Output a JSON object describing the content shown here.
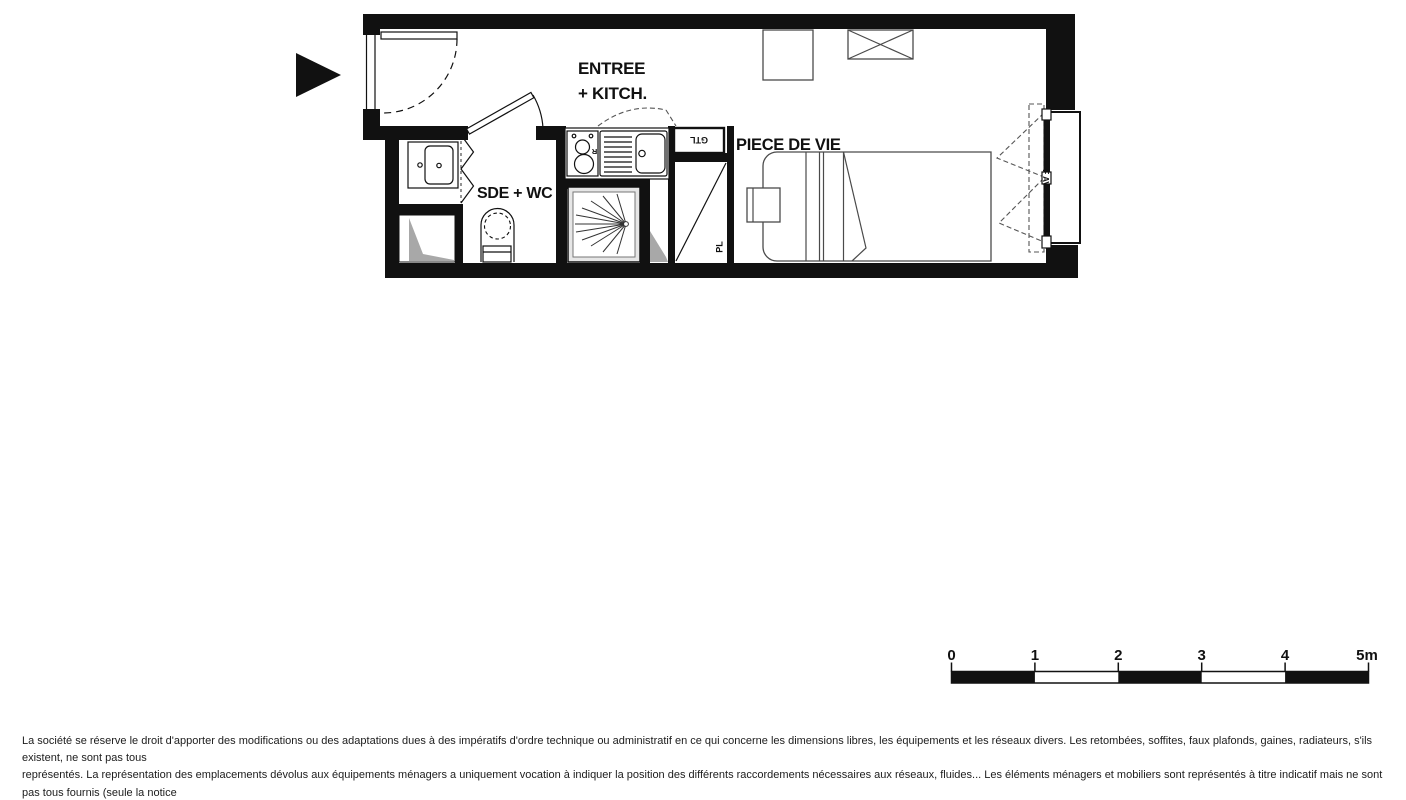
{
  "plan": {
    "labels": {
      "entree_line1": "ENTREE",
      "entree_line2": "+ KITCH.",
      "sde_wc": "SDE + WC",
      "piece_de_vie": "PIECE DE VIE",
      "gtl": "GTL",
      "pl": "PL",
      "fridge": "R",
      "window": "F AV"
    },
    "colors": {
      "wall": "#111111",
      "furniture_line": "#4a4a4a",
      "shade_gray": "#a8a8a8",
      "shower_fill": "#e6e6e6",
      "background": "#ffffff"
    }
  },
  "scale_bar": {
    "labels": [
      "0",
      "1",
      "2",
      "3",
      "4",
      "5m"
    ]
  },
  "disclaimer": {
    "lines": [
      "La société se réserve le droit d'apporter des modifications ou des adaptations dues à des impératifs d'ordre technique ou administratif en ce qui concerne les dimensions libres, les équipements et les réseaux divers. Les retombées, soffites, faux plafonds, gaines, radiateurs, s'ils existent, ne sont pas tous",
      "représentés. La représentation des emplacements dévolus aux équipements ménagers a uniquement vocation à indiquer la position des différents raccordements nécessaires aux réseaux, fluides... Les éléments ménagers et mobiliers sont représentés à titre indicatif mais ne sont pas tous fournis (seule la notice",
      "descriptive précise les équipements fournis). Les surfaces y compris celles des jardins sont approximatives et susceptibles d'être modifiées."
    ]
  }
}
